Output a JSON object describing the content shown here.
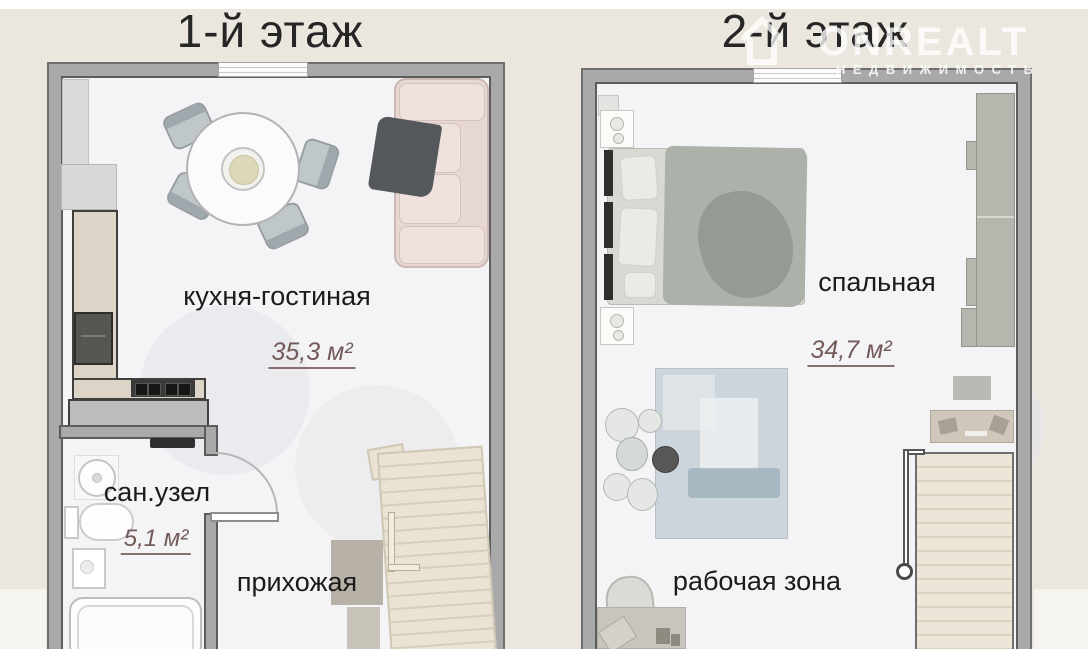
{
  "titles": {
    "floor1": "1-й этаж",
    "floor2": "2-й этаж"
  },
  "floor1": {
    "rooms": {
      "kitchen_living": {
        "label": "кухня-гостиная",
        "area": "35,3 м²"
      },
      "bathroom": {
        "label": "сан.узел",
        "area": "5,1 м²"
      },
      "hallway": {
        "label": "прихожая"
      }
    }
  },
  "floor2": {
    "rooms": {
      "bedroom": {
        "label": "спальная",
        "area": "34,7 м²"
      },
      "work_zone": {
        "label": "рабочая зона"
      }
    }
  },
  "watermark": {
    "brand": "ONREALT",
    "subtitle": "НЕДВИЖИМОСТЬ"
  },
  "colors": {
    "background": "#ebe7df",
    "wall": "#a9a9a9",
    "wall_border": "#5c5c5c",
    "interior": "#f4f4f6",
    "area_text": "#735a58",
    "sofa": "#e7d7d2",
    "stairs": "#eae2d2",
    "rug": "#ccd5dc"
  }
}
